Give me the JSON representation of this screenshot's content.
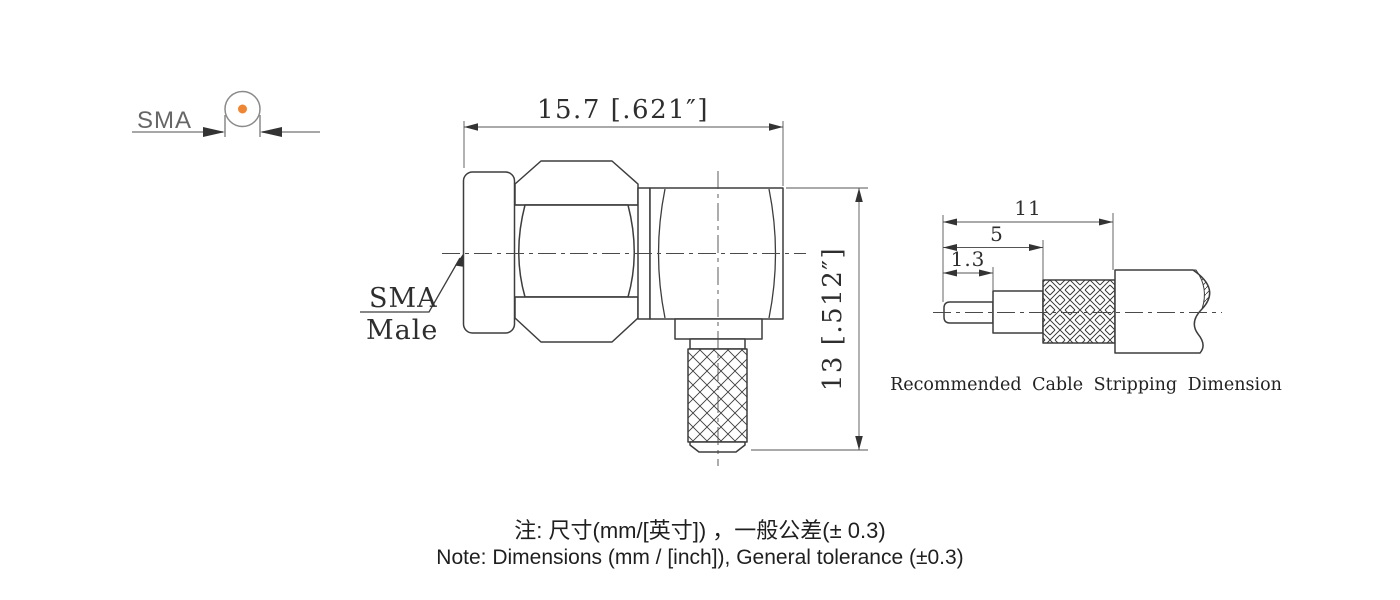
{
  "sma_symbol": {
    "label": "SMA"
  },
  "main_view": {
    "width_dim": "15.7 [.621″]",
    "height_dim": "13 [.512″]",
    "part_label_line1": "SMA",
    "part_label_line2": "Male"
  },
  "stripping_view": {
    "caption": "Recommended Cable Stripping Dimension",
    "dim_total": "11",
    "dim_dielectric": "5",
    "dim_conductor": "1.3"
  },
  "notes": {
    "line1_zh": "注: 尺寸(mm/[英寸]) ，一般公差(± 0.3)",
    "line2_en": "Note: Dimensions (mm / [inch]), General tolerance (±0.3)"
  },
  "colors": {
    "accent_orange": "#ef8634",
    "line_dark": "#3d3d3d",
    "line_thin": "#555555"
  }
}
